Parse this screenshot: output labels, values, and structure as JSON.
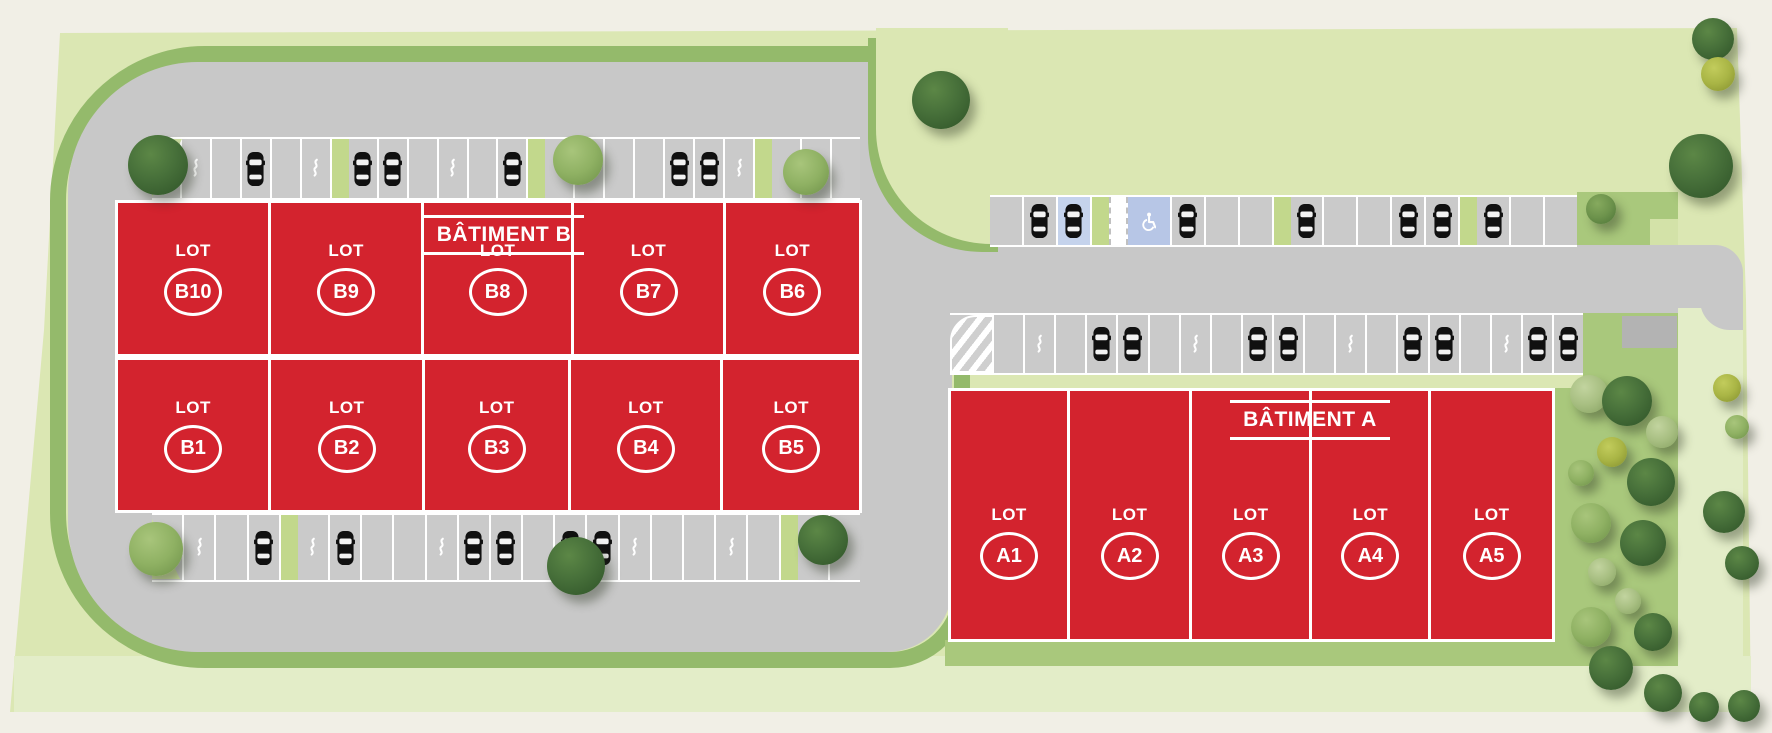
{
  "plan": {
    "type": "residential/commercial site plan",
    "lot_word": "LOT"
  },
  "buildings": {
    "lot_word": "LOT",
    "b": {
      "label": "BÂTIMENT B",
      "top_row": [
        "B10",
        "B9",
        "B8",
        "B7",
        "B6"
      ],
      "bottom_row": [
        "B1",
        "B2",
        "B3",
        "B4",
        "B5"
      ]
    },
    "a": {
      "label": "BÂTIMENT A",
      "row": [
        "A1",
        "A2",
        "A3",
        "A4",
        "A5"
      ]
    }
  },
  "parking": {
    "b_top": [
      "empty",
      "ev",
      "empty",
      "car",
      "empty",
      "ev",
      "planter",
      "car",
      "car",
      "empty",
      "ev",
      "empty",
      "car",
      "planter",
      "empty",
      "ev",
      "empty",
      "empty",
      "car",
      "car",
      "ev",
      "planter",
      "empty",
      "ev",
      "empty"
    ],
    "b_bottom": [
      "empty",
      "ev",
      "empty",
      "car",
      "planter",
      "ev",
      "car",
      "empty",
      "empty",
      "ev",
      "car",
      "car",
      "empty",
      "car",
      "car",
      "ev",
      "empty",
      "empty",
      "ev",
      "empty",
      "planter",
      "ev",
      "empty"
    ],
    "a_top": [
      "empty",
      "car",
      "car_blue",
      "planter",
      "walkway",
      "handicap",
      "car",
      "empty",
      "empty",
      "planter",
      "car",
      "empty",
      "empty",
      "car",
      "car",
      "planter",
      "car",
      "empty",
      "empty"
    ],
    "a_bottom": [
      "hatch",
      "empty",
      "ev",
      "empty",
      "car",
      "car",
      "empty",
      "ev",
      "empty",
      "car",
      "car",
      "empty",
      "ev",
      "empty",
      "car",
      "car",
      "empty",
      "ev",
      "car",
      "car"
    ]
  },
  "icons": {
    "car": "car-top-icon",
    "ev": "ev-charging-icon",
    "handicap": "wheelchair-icon"
  },
  "colors": {
    "background_beige": "#f1efe6",
    "site_green": "#dbe7b3",
    "pale_green": "#e3edc8",
    "accent_dark_green": "#94ba6b",
    "landscape_green": "#a9c87c",
    "planter_green": "#c2d88c",
    "road_gray": "#c8c8c8",
    "parking_gray": "#cacaca",
    "lot_red": "#d3232e",
    "handicap_blue": "#b7c6e6",
    "spot_blue": "#c5d3ec",
    "shed_gray": "#b3b3b3",
    "white": "#ffffff"
  },
  "landscape": {
    "trees": [
      [
        158,
        165,
        30,
        "dark"
      ],
      [
        578,
        160,
        25,
        "light"
      ],
      [
        806,
        172,
        23,
        "light"
      ],
      [
        941,
        100,
        29,
        "dark"
      ],
      [
        1713,
        39,
        21,
        "dark"
      ],
      [
        1718,
        74,
        17,
        "yellow"
      ],
      [
        1701,
        166,
        32,
        "dark"
      ],
      [
        1601,
        209,
        15,
        "mid"
      ],
      [
        156,
        549,
        27,
        "light"
      ],
      [
        576,
        566,
        29,
        "dark"
      ],
      [
        823,
        540,
        25,
        "dark"
      ],
      [
        1589,
        394,
        19,
        "pale"
      ],
      [
        1627,
        401,
        25,
        "dark"
      ],
      [
        1662,
        432,
        16,
        "pale"
      ],
      [
        1612,
        452,
        15,
        "yellow"
      ],
      [
        1651,
        482,
        24,
        "dark"
      ],
      [
        1581,
        473,
        13,
        "light"
      ],
      [
        1591,
        523,
        20,
        "light"
      ],
      [
        1643,
        543,
        23,
        "dark"
      ],
      [
        1602,
        572,
        14,
        "pale"
      ],
      [
        1628,
        601,
        13,
        "pale"
      ],
      [
        1591,
        627,
        20,
        "light"
      ],
      [
        1653,
        632,
        19,
        "dark"
      ],
      [
        1611,
        668,
        22,
        "dark"
      ],
      [
        1663,
        693,
        19,
        "dark"
      ],
      [
        1704,
        707,
        15,
        "dark"
      ],
      [
        1727,
        388,
        14,
        "yellow"
      ],
      [
        1737,
        427,
        12,
        "light"
      ],
      [
        1724,
        512,
        21,
        "dark"
      ],
      [
        1742,
        563,
        17,
        "dark"
      ],
      [
        1744,
        706,
        16,
        "dark"
      ]
    ]
  }
}
